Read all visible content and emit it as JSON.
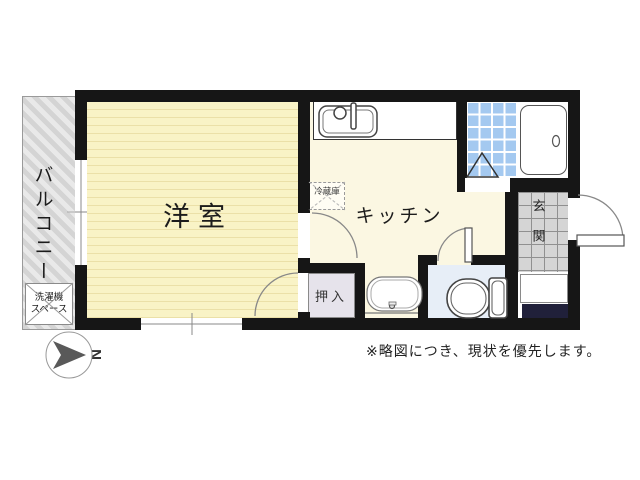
{
  "plan": {
    "labels": {
      "balcony": "バルコニー",
      "laundry_line1": "洗濯機",
      "laundry_line2": "スペース",
      "western_room": "洋室",
      "kitchen": "キッチン",
      "refrigerator": "冷蔵庫",
      "closet": "押入",
      "entrance": "玄関",
      "compass_letter": "N"
    },
    "caption": "※略図につき、現状を優先します。",
    "colors": {
      "wall": "#161616",
      "western_room_floor": "#f9f3c6",
      "western_room_stripe": "#ebe0a8",
      "kitchen_floor": "#fbf7e2",
      "bath_tile": "#a4c9f0",
      "toilet_floor": "#e7eef7",
      "closet_floor": "#e6e3eb",
      "entrance_tile": "#d5d5d5",
      "balcony_hatch": "#d4d4d4",
      "step_dark": "#20203a"
    }
  }
}
